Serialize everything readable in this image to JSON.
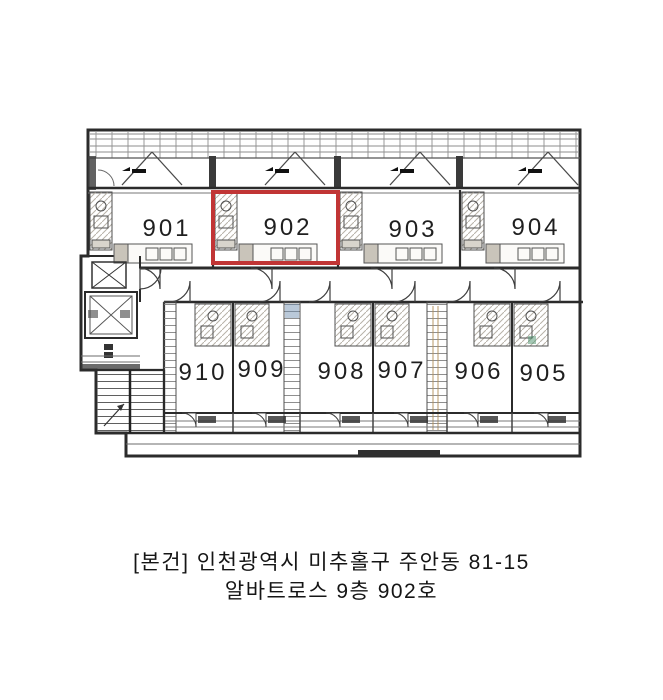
{
  "plan": {
    "type": "floor-plan",
    "floor": "9",
    "highlighted_room": "902",
    "highlight_color": "#c13535",
    "line_color": "#2b2b2b",
    "rooms_top": [
      {
        "number": "901"
      },
      {
        "number": "902"
      },
      {
        "number": "903"
      },
      {
        "number": "904"
      }
    ],
    "rooms_bottom": [
      {
        "number": "910"
      },
      {
        "number": "909"
      },
      {
        "number": "908"
      },
      {
        "number": "907"
      },
      {
        "number": "906"
      },
      {
        "number": "905"
      }
    ]
  },
  "caption": {
    "line1": "[본건] 인천광역시 미추홀구 주안동 81-15",
    "line2": "알바트로스 9층 902호"
  }
}
